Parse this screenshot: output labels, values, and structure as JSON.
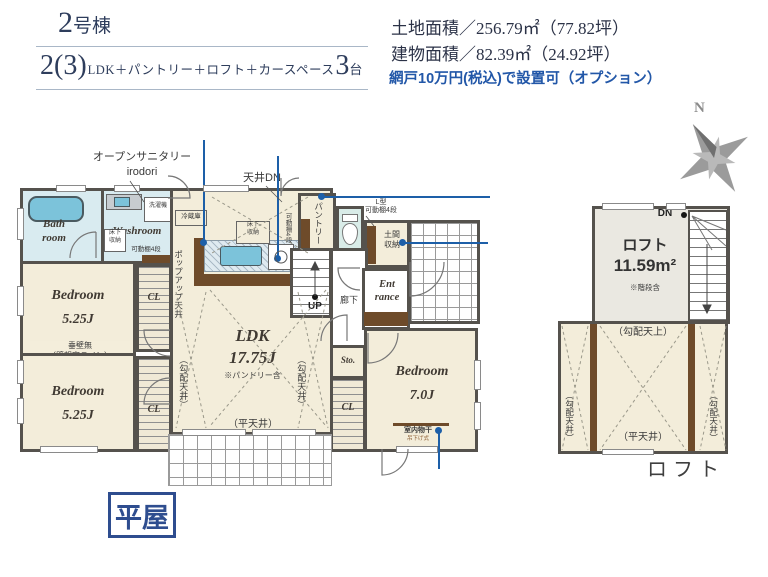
{
  "header": {
    "building_num": "2",
    "building_suffix": "号棟",
    "plan_prefix": "2(3)",
    "plan_middle": "LDK＋パントリー＋ロフト＋カースペース",
    "plan_count": "3",
    "plan_unit": "台",
    "land_area": "土地面積／256.79㎡（77.82坪）",
    "building_area": "建物面積／82.39㎡（24.92坪）",
    "option_note": "網戸10万円(税込)で設置可（オプション）"
  },
  "compass": {
    "n": "N"
  },
  "tags": {
    "floor": "平屋",
    "loft": "ロフト"
  },
  "plan": {
    "callouts": {
      "open_sanitary": "オープンサニタリー\nirodori",
      "ceiling_dn": "天井DN",
      "l_shelf": "L型\n可動棚4段",
      "laundry": "室内物干",
      "laundry_sub": "吊下げ式",
      "wall_note": "垂壁無\n（壁想定ライン）"
    },
    "rooms": {
      "bath": "Bath\nroom",
      "washroom": "Washroom",
      "washer": "洗濯機",
      "underfloor": "床下\n収納",
      "underfloor2": "床下\n収納",
      "shelf4": "可動棚4段",
      "fridge": "冷蔵庫",
      "popup_ceiling": "ポップアップ天井",
      "pantry": "パントリー",
      "pantry_shelf": "可動棚4段",
      "doma": "土間\n収納",
      "entrance": "Ent\nrance",
      "hall": "廊下",
      "up": "UP",
      "sto": "Sto.",
      "cl": "CL",
      "bedroom1": "Bedroom\n5.25J",
      "bedroom2": "Bedroom\n5.25J",
      "bedroom3": "Bedroom\n7.0J",
      "ldk": "LDK\n17.75J",
      "ldk_note": "※パントリー含",
      "sloped_ceiling": "（勾配天井）",
      "flat_ceiling": "（平天井）"
    }
  },
  "loft": {
    "name": "ロフト",
    "area": "11.59m²",
    "note": "※階段含",
    "dn": "DN",
    "sloped_top": "（勾配天上）",
    "sloped_ceiling": "（勾配天井）",
    "flat_ceiling": "（平天井）"
  },
  "colors": {
    "accent_blue": "#1d5fa8",
    "wall": "#55524d",
    "floor_beige": "#f3edda",
    "wet_blue": "#d9ebf0",
    "fixture_blue": "#7cc3da",
    "wood_brown": "#6e4b2a",
    "header_navy": "#2e3d5c",
    "option_blue": "#2257a8",
    "tag_navy": "#2e4d8f"
  }
}
